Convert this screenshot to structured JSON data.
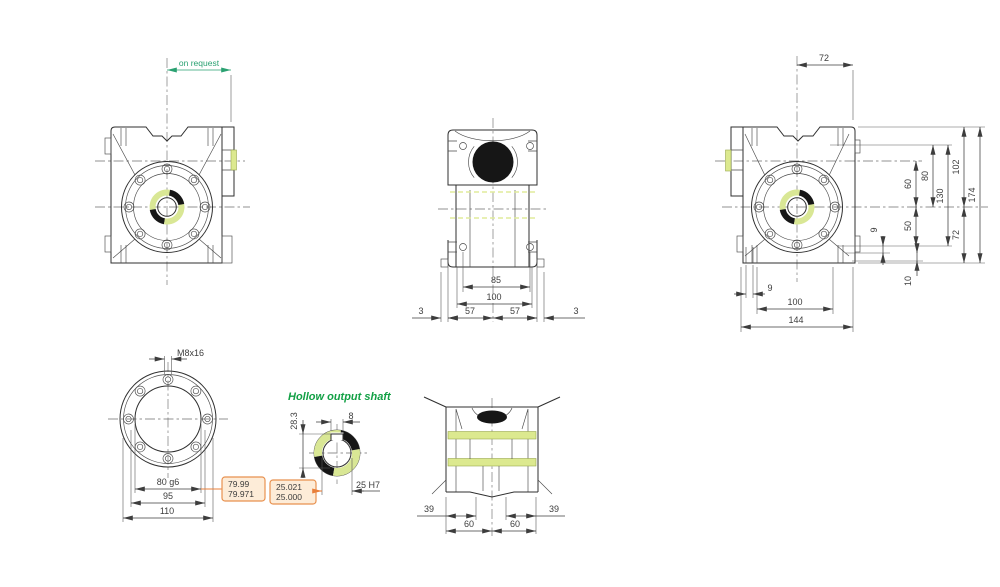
{
  "drawing_type": "worm-gearbox-dimensional-drawing",
  "views": {
    "front": {
      "on_request": "on request"
    },
    "top": {
      "dim_85": "85",
      "dim_100": "100",
      "dim_3_left": "3",
      "dim_57_left": "57",
      "dim_57_right": "57",
      "dim_3_right": "3"
    },
    "side": {
      "dim_72_top": "72",
      "dim_60": "60",
      "dim_80": "80",
      "dim_130": "130",
      "dim_102": "102",
      "dim_174": "174",
      "dim_50": "50",
      "dim_72_right": "72",
      "dim_9_step": "9",
      "dim_10": "10",
      "dim_9_foot": "9",
      "dim_100": "100",
      "dim_144": "144"
    },
    "flange": {
      "thread": "M8x16",
      "dim_80g6": "80 g6",
      "dim_95": "95",
      "dim_110": "110"
    },
    "shaft": {
      "title": "Hollow output shaft",
      "dim_28_3": "28.3",
      "dim_8": "8",
      "dim_25h7": "25 H7",
      "tol_80": {
        "upper": "79.99",
        "lower": "79.971"
      },
      "tol_25": {
        "upper": "25.021",
        "lower": "25.000"
      }
    },
    "bottom": {
      "dim_39_left": "39",
      "dim_60_left": "60",
      "dim_60_right": "60",
      "dim_39_right": "39"
    }
  },
  "colors": {
    "outline": "#2f2f2f",
    "dimension_text": "#3d3d3d",
    "green_note": "#2aa171",
    "green_title": "#12a045",
    "highlight_yellow": "#dce98f",
    "filled_black": "#161616",
    "tolerance_box_fill": "#fdecd8",
    "tolerance_box_border": "#e8914f",
    "leader_orange": "#e87f3a"
  }
}
